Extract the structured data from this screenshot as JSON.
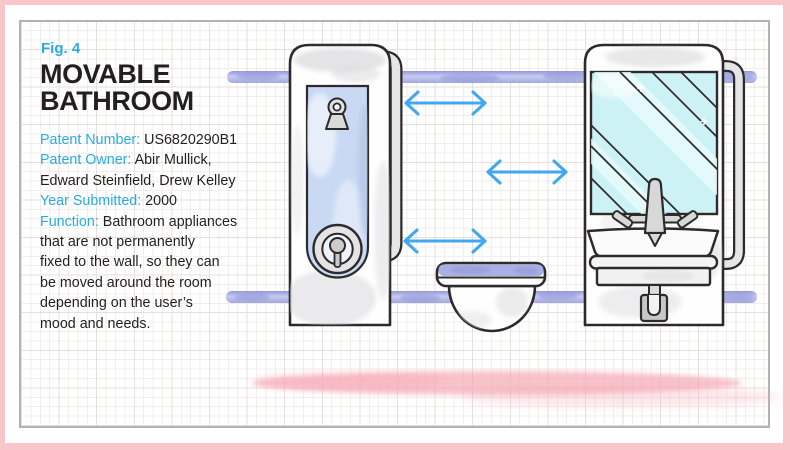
{
  "figure": {
    "label": "Fig. 4",
    "title_line1": "MOVABLE",
    "title_line2": "BATHROOM"
  },
  "info": {
    "lines": [
      {
        "label": "Patent Number:",
        "text": " US6820290B1"
      },
      {
        "label": "Patent Owner:",
        "text": " Abir Mullick,"
      },
      {
        "label": "",
        "text": "Edward Steinfield, Drew Kelley"
      },
      {
        "label": "Year Submitted:",
        "text": " 2000"
      },
      {
        "label": "Function:",
        "text": " Bathroom appliances"
      },
      {
        "label": "",
        "text": "that are not permanently"
      },
      {
        "label": "",
        "text": "fixed to the wall, so they can"
      },
      {
        "label": "",
        "text": "be moved around the room"
      },
      {
        "label": "",
        "text": "depending on the user’s"
      },
      {
        "label": "",
        "text": "mood and needs."
      }
    ]
  },
  "illustration": {
    "icons": [
      "shower-unit-icon",
      "shower-head-icon",
      "shower-dial-icon",
      "toilet-icon",
      "sink-mirror-unit-icon",
      "faucet-icon",
      "drain-trap-icon",
      "sliding-rail-icon",
      "hook-tube-icon",
      "double-arrow-icon",
      "pink-smear-icon"
    ]
  },
  "colors": {
    "framepink": "#f9c6ca",
    "panelborder": "#b3b1b1",
    "gridminor": "#f3eded",
    "gridmajor": "#e5dfdf",
    "accent": "#29abe2",
    "ink": "#231f20",
    "outline": "#2d2a2b",
    "rail": "#b4b8e8",
    "raildark": "#8e94d6",
    "unit": "#fefefe",
    "shade": "#d9d9dc",
    "doorblue": "#c9d9f3",
    "mirror": "#cdf2f6",
    "streak": "#e9fbfc",
    "metal": "#d8d8d8",
    "tube": "#e6e6e6",
    "arrow": "#3fa8f0",
    "smear": "#f6a9b5",
    "seat": "#a9b0e3"
  }
}
